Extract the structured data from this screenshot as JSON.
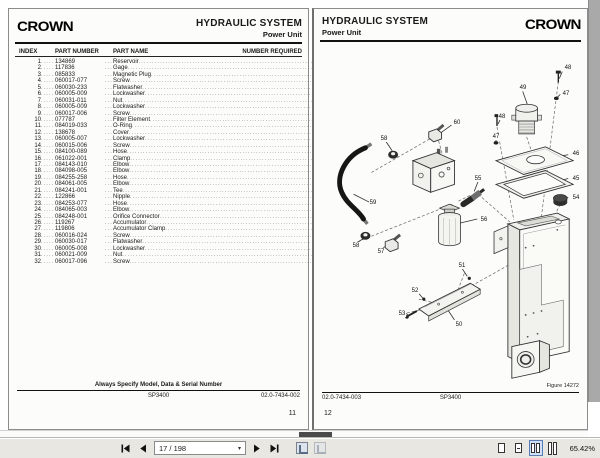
{
  "toolbar": {
    "page_indicator": "17 / 198",
    "zoom_level": "65.42%",
    "icons": [
      "first-page-icon",
      "prev-page-icon",
      "page-dropdown-caret",
      "next-page-icon",
      "last-page-icon",
      "prev-view-icon",
      "next-view-icon",
      "single-page-icon",
      "continuous-icon",
      "facing-pages-icon",
      "continuous-facing-icon"
    ]
  },
  "colors": {
    "page_bg": "#fcfcfa",
    "toolbar_bg": "#e9e7e2",
    "scrollbar": "#a9a9a9",
    "text": "#1a1a1a",
    "selected_view_bg": "#cfdff5"
  },
  "left_page": {
    "logo": "CROWN",
    "title": "HYDRAULIC SYSTEM",
    "subtitle": "Power Unit",
    "table": {
      "headers": {
        "index": "INDEX",
        "part_number": "PART NUMBER",
        "part_name": "PART NAME",
        "number_required": "NUMBER REQUIRED"
      },
      "rows": [
        {
          "index": "1",
          "part_number": "134869",
          "part_name": "Reservoir",
          "qty": "1"
        },
        {
          "index": "2",
          "part_number": "117836",
          "part_name": "Gage",
          "qty": "1"
        },
        {
          "index": "3",
          "part_number": "085833",
          "part_name": "Magnetic Plug",
          "qty": "1"
        },
        {
          "index": "4",
          "part_number": "060017-077",
          "part_name": "Screw",
          "qty": "4"
        },
        {
          "index": "5",
          "part_number": "060030-233",
          "part_name": "Flatwasher",
          "qty": "3"
        },
        {
          "index": "6",
          "part_number": "060005-009",
          "part_name": "Lockwasher",
          "qty": "3"
        },
        {
          "index": "7",
          "part_number": "060031-011",
          "part_name": "Nut",
          "qty": "3"
        },
        {
          "index": "8",
          "part_number": "060005-009",
          "part_name": "Lockwasher",
          "qty": "4"
        },
        {
          "index": "9",
          "part_number": "060017-006",
          "part_name": "Screw",
          "qty": "2"
        },
        {
          "index": "10",
          "part_number": "077787",
          "part_name": "Filter Element",
          "qty": "1"
        },
        {
          "index": "11",
          "part_number": "084019-033",
          "part_name": "O-Ring",
          "qty": "1"
        },
        {
          "index": "12",
          "part_number": "138678",
          "part_name": "Cover",
          "qty": "1"
        },
        {
          "index": "13",
          "part_number": "060005-007",
          "part_name": "Lockwasher",
          "qty": "4"
        },
        {
          "index": "14",
          "part_number": "060015-006",
          "part_name": "Screw",
          "qty": "4"
        },
        {
          "index": "15",
          "part_number": "084100-089",
          "part_name": "Hose",
          "qty": "2"
        },
        {
          "index": "16",
          "part_number": "061022-001",
          "part_name": "Clamp",
          "qty": "4"
        },
        {
          "index": "17",
          "part_number": "084143-010",
          "part_name": "Elbow",
          "qty": "2"
        },
        {
          "index": "18",
          "part_number": "084098-005",
          "part_name": "Elbow",
          "qty": "2"
        },
        {
          "index": "19",
          "part_number": "084255-258",
          "part_name": "Hose",
          "qty": "4"
        },
        {
          "index": "20",
          "part_number": "084061-005",
          "part_name": "Elbow",
          "qty": "1"
        },
        {
          "index": "21",
          "part_number": "084241-001",
          "part_name": "Tee",
          "qty": "1"
        },
        {
          "index": "22",
          "part_number": "122866",
          "part_name": "Nipple",
          "qty": "1"
        },
        {
          "index": "23",
          "part_number": "084253-077",
          "part_name": "Hose",
          "qty": "1"
        },
        {
          "index": "24",
          "part_number": "084065-003",
          "part_name": "Elbow",
          "qty": "1"
        },
        {
          "index": "25",
          "part_number": "084248-001",
          "part_name": "Orifice Connector",
          "qty": "1"
        },
        {
          "index": "26",
          "part_number": "119267",
          "part_name": "Accumulator",
          "qty": "1"
        },
        {
          "index": "27",
          "part_number": "119806",
          "part_name": "Accumulator Clamp",
          "qty": "1"
        },
        {
          "index": "28",
          "part_number": "060016-024",
          "part_name": "Screw",
          "qty": "1"
        },
        {
          "index": "29",
          "part_number": "060030-017",
          "part_name": "Flatwasher",
          "qty": "1"
        },
        {
          "index": "30",
          "part_number": "060005-008",
          "part_name": "Lockwasher",
          "qty": "1"
        },
        {
          "index": "31",
          "part_number": "060021-009",
          "part_name": "Nut",
          "qty": "1"
        },
        {
          "index": "32",
          "part_number": "060017-096",
          "part_name": "Screw",
          "qty": "2"
        }
      ]
    },
    "footer": {
      "note": "Always Specify Model, Data & Serial Number",
      "model": "SP3400",
      "doc_number": "02.0-7434-002",
      "page_number": "11"
    }
  },
  "right_page": {
    "logo": "CROWN",
    "title": "HYDRAULIC SYSTEM",
    "subtitle": "Power Unit",
    "figure": {
      "caption": "Figure 14272",
      "callouts": [
        {
          "label": "48",
          "x": 254,
          "y": 59
        },
        {
          "label": "47",
          "x": 252,
          "y": 85
        },
        {
          "label": "49",
          "x": 209,
          "y": 79
        },
        {
          "label": "48",
          "x": 188,
          "y": 108
        },
        {
          "label": "47",
          "x": 182,
          "y": 128
        },
        {
          "label": "46",
          "x": 262,
          "y": 145
        },
        {
          "label": "45",
          "x": 262,
          "y": 170
        },
        {
          "label": "55",
          "x": 164,
          "y": 170
        },
        {
          "label": "54",
          "x": 262,
          "y": 189
        },
        {
          "label": "60",
          "x": 143,
          "y": 114
        },
        {
          "label": "58",
          "x": 70,
          "y": 130
        },
        {
          "label": "59",
          "x": 59,
          "y": 194
        },
        {
          "label": "58",
          "x": 42,
          "y": 237
        },
        {
          "label": "57",
          "x": 67,
          "y": 243
        },
        {
          "label": "56",
          "x": 170,
          "y": 211
        },
        {
          "label": "51",
          "x": 148,
          "y": 257
        },
        {
          "label": "52",
          "x": 101,
          "y": 282
        },
        {
          "label": "53",
          "x": 88,
          "y": 305
        },
        {
          "label": "50",
          "x": 145,
          "y": 316
        }
      ]
    },
    "footer": {
      "doc_number": "02.0-7434-003",
      "model": "SP3400",
      "page_number": "12"
    }
  }
}
